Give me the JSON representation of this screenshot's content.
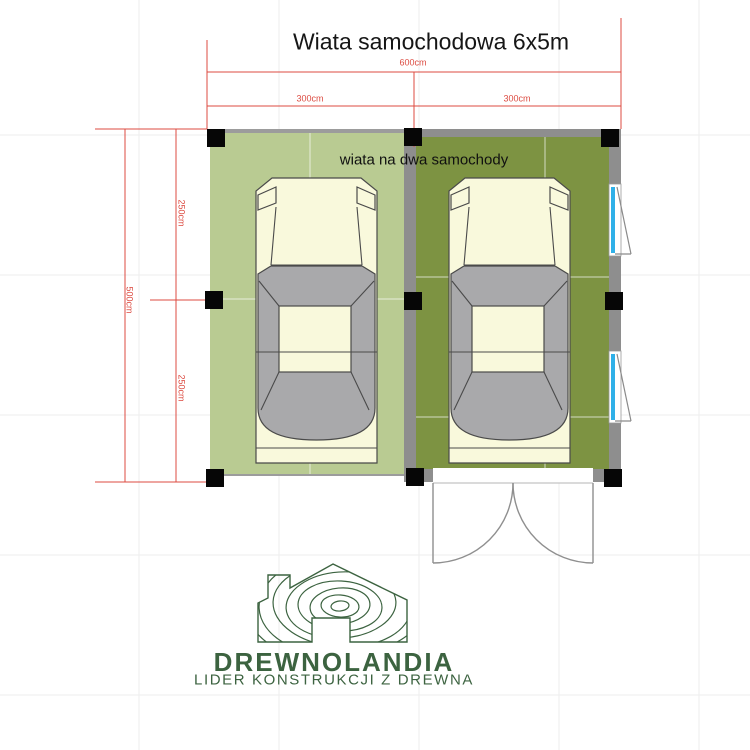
{
  "title": "Wiata samochodowa 6x5m",
  "plan_label": "wiata na dwa samochody",
  "dimensions": {
    "total_width": "600cm",
    "bay_left_width": "300cm",
    "bay_right_width": "300cm",
    "total_depth": "500cm",
    "depth_front": "250cm",
    "depth_rear": "250cm"
  },
  "logo": {
    "name": "DREWNOLANDIA",
    "tagline": "LIDER KONSTRUKCJI Z DREWNA"
  },
  "colors": {
    "dim-red": "#dc4b41",
    "pad-left": "#b9cb92",
    "pad-right": "#7d9342",
    "wall-gray": "#8e8e8e",
    "post-black": "#060606",
    "car-body": "#f9f9dc",
    "car-glass": "#a9a9ab",
    "window-cyan": "#2fb0e8",
    "logo-green": "#3c6340"
  }
}
